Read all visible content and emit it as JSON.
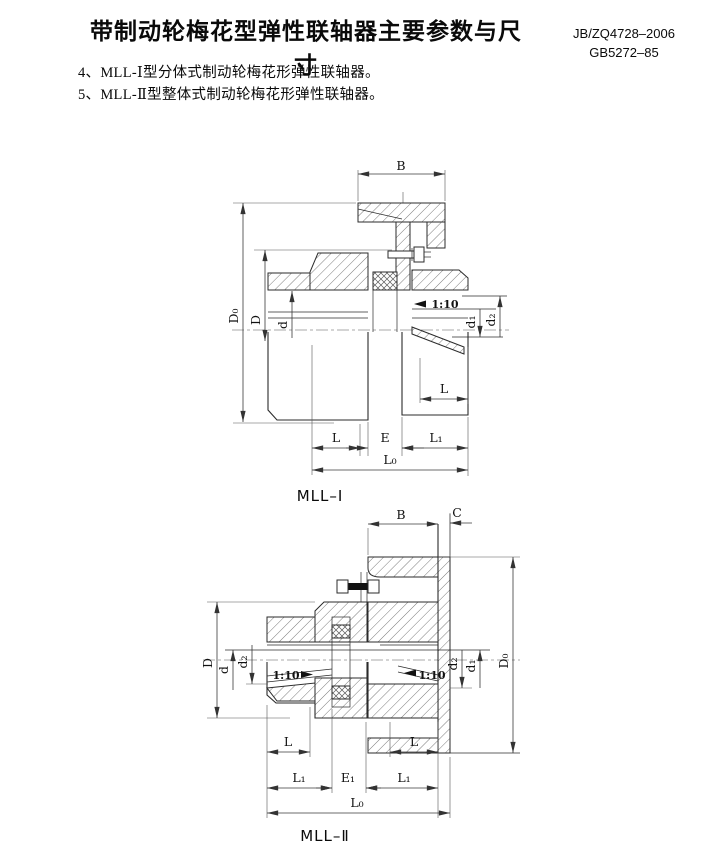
{
  "header": {
    "title": "带制动轮梅花型弹性联轴器主要参数与尺寸",
    "standard_1": "JB/ZQ4728–2006",
    "standard_2": "GB5272–85"
  },
  "notes": {
    "item_4": "4、MLL-Ⅰ型分体式制动轮梅花形弹性联轴器。",
    "item_5": "5、MLL-Ⅱ型整体式制动轮梅花形弹性联轴器。"
  },
  "figure_1": {
    "caption": "MLL–Ⅰ",
    "dims": {
      "b": "B",
      "d0": "D₀",
      "dd": "D",
      "d": "d",
      "d1": "d₁",
      "d2": "d₂",
      "taper": "1:10",
      "l_bore": "L",
      "l": "L",
      "e": "E",
      "l1": "L₁",
      "l0": "L₀"
    }
  },
  "figure_2": {
    "caption": "MLL–Ⅱ",
    "dims": {
      "b": "B",
      "c": "C",
      "dd": "D",
      "d": "d",
      "d2_left": "d₂",
      "taper_left": "1:10",
      "taper_right": "1:10",
      "d2_right": "d₂",
      "d1": "d₁",
      "d0": "D₀",
      "l_left": "L",
      "l_right": "L",
      "l1_left": "L₁",
      "e1": "E₁",
      "l1_right": "L₁",
      "l0": "L₀"
    }
  }
}
